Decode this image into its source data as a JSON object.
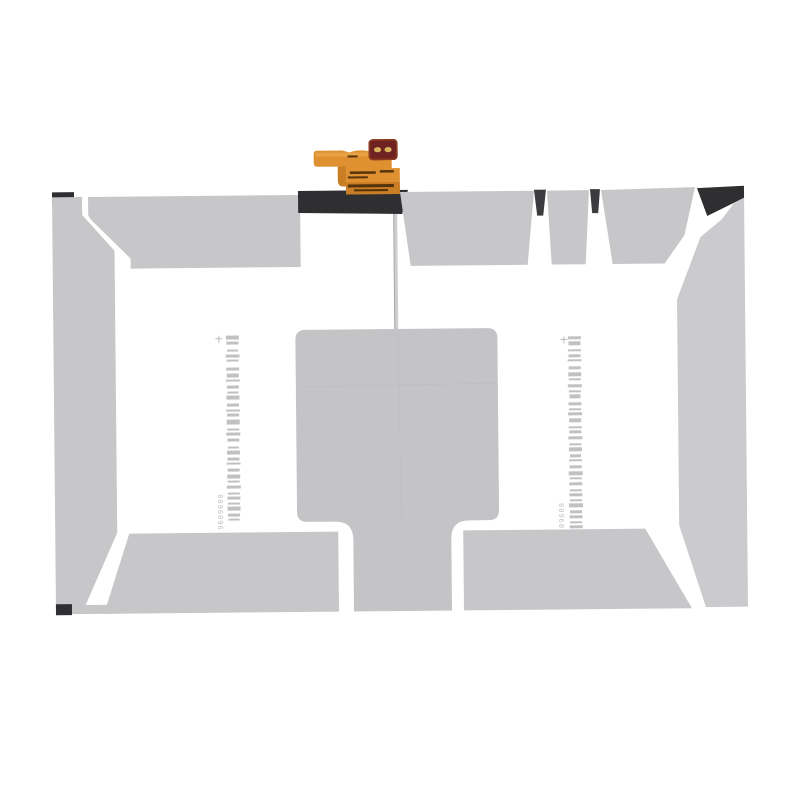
{
  "image": {
    "kind": "product-photo-tablet-battery",
    "background": "#ffffff"
  },
  "battery": {
    "colors": {
      "tape": "#c7c7c9",
      "tape_light": "#cbcbcd",
      "pad": "#c4c4c6",
      "pad_seam": "#b2b2b5",
      "edge_dark": "#2f2f32",
      "notch_dark": "#3c3c3f",
      "wire": "#cfcfd1",
      "wire_edge": "#a9a9ac",
      "white_gap": "#ffffff"
    },
    "flex": {
      "ribbon": "#df9030",
      "ribbon_dark": "#b76d1d",
      "ribbon_light": "#f1b057",
      "connector_body": "#6e2322",
      "connector_rim": "#8a3a1d",
      "connector_pads": "#d9b15b",
      "marking_dark": "#3f2508"
    },
    "barcode_left": {
      "digits": "9609608",
      "color": "#acacb0",
      "text_color": "#c3c3c6",
      "bars": [
        [
          3,
          4,
          13
        ],
        [
          2,
          3,
          12
        ],
        [
          5,
          2,
          11
        ],
        [
          3,
          3,
          14
        ],
        [
          2,
          2,
          12
        ],
        [
          6,
          3,
          13
        ],
        [
          3,
          4,
          12
        ],
        [
          2,
          2,
          14
        ],
        [
          4,
          3,
          12
        ],
        [
          3,
          2,
          11
        ],
        [
          2,
          4,
          13
        ],
        [
          4,
          3,
          12
        ],
        [
          3,
          2,
          14
        ],
        [
          2,
          3,
          12
        ],
        [
          3,
          5,
          13
        ],
        [
          4,
          2,
          12
        ],
        [
          2,
          3,
          14
        ],
        [
          3,
          3,
          12
        ],
        [
          5,
          2,
          11
        ],
        [
          2,
          4,
          13
        ],
        [
          3,
          3,
          12
        ],
        [
          2,
          2,
          14
        ],
        [
          4,
          3,
          12
        ],
        [
          3,
          4,
          13
        ],
        [
          2,
          2,
          12
        ],
        [
          3,
          3,
          14
        ],
        [
          4,
          2,
          12
        ],
        [
          2,
          3,
          13
        ],
        [
          3,
          2,
          12
        ],
        [
          2,
          4,
          13
        ],
        [
          3,
          3,
          12
        ],
        [
          2,
          2,
          11
        ]
      ]
    },
    "barcode_right": {
      "digits": "0109608",
      "color": "#acacb0",
      "text_color": "#c3c3c6",
      "bars": [
        [
          3,
          3,
          13
        ],
        [
          2,
          4,
          12
        ],
        [
          4,
          2,
          13
        ],
        [
          3,
          3,
          12
        ],
        [
          2,
          2,
          14
        ],
        [
          5,
          3,
          12
        ],
        [
          3,
          4,
          13
        ],
        [
          2,
          2,
          12
        ],
        [
          4,
          3,
          14
        ],
        [
          3,
          2,
          12
        ],
        [
          2,
          4,
          11
        ],
        [
          4,
          3,
          13
        ],
        [
          3,
          2,
          12
        ],
        [
          2,
          3,
          14
        ],
        [
          3,
          4,
          12
        ],
        [
          4,
          2,
          13
        ],
        [
          2,
          3,
          12
        ],
        [
          3,
          3,
          14
        ],
        [
          4,
          2,
          12
        ],
        [
          2,
          4,
          13
        ],
        [
          3,
          3,
          11
        ],
        [
          2,
          2,
          13
        ],
        [
          4,
          3,
          12
        ],
        [
          3,
          4,
          14
        ],
        [
          2,
          2,
          12
        ],
        [
          3,
          3,
          13
        ],
        [
          4,
          2,
          12
        ],
        [
          2,
          3,
          13
        ],
        [
          3,
          2,
          12
        ],
        [
          2,
          4,
          14
        ],
        [
          3,
          3,
          12
        ],
        [
          2,
          3,
          13
        ],
        [
          3,
          2,
          12
        ],
        [
          2,
          3,
          13
        ]
      ]
    }
  }
}
